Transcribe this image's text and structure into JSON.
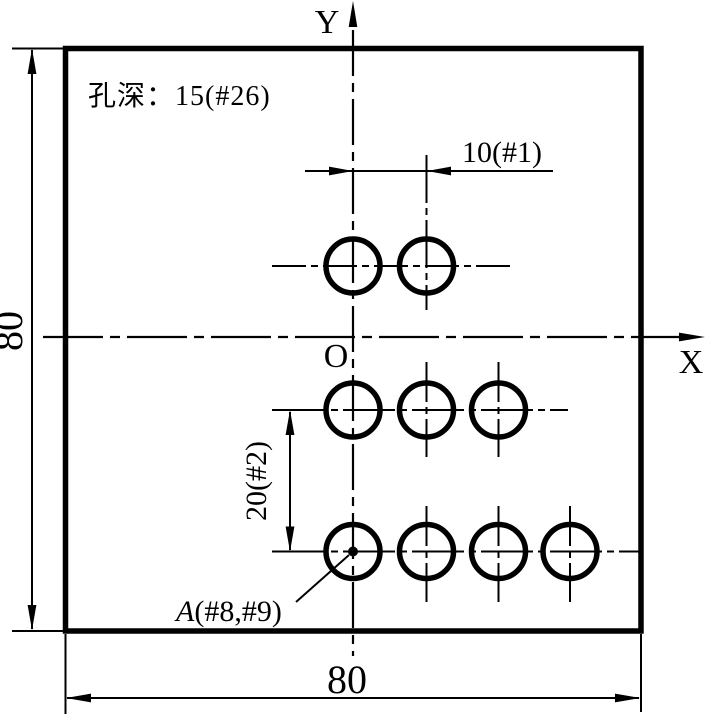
{
  "drawing": {
    "background": "#ffffff",
    "line_color": "#000000",
    "note_hole_depth": "孔深：15(#26)",
    "labels": {
      "axis_x": "X",
      "axis_y": "Y",
      "origin": "O",
      "dim_plate_height": "80",
      "dim_plate_width": "80",
      "dim_hole_pitch_x": "10(#1)",
      "dim_row_pitch_y": "20(#2)",
      "point_a_name": "A",
      "point_a_registers": "(#8,#9)"
    },
    "plate": {
      "width_units": 80,
      "height_units": 80
    },
    "holes": {
      "depth_units": 15,
      "depth_register": "#26",
      "pitch_x_units": 10,
      "pitch_x_register": "#1",
      "row_pitch_y_units": 20,
      "row_pitch_y_register": "#2",
      "rows": [
        {
          "y_units": 10,
          "x_positions_units": [
            0,
            10
          ]
        },
        {
          "y_units": -10,
          "x_positions_units": [
            0,
            10,
            20
          ]
        },
        {
          "y_units": -30,
          "x_positions_units": [
            0,
            10,
            20,
            30
          ]
        }
      ],
      "point_a": {
        "name": "A",
        "registers": "#8,#9",
        "location": "first hole of bottom row on Y axis"
      }
    }
  }
}
